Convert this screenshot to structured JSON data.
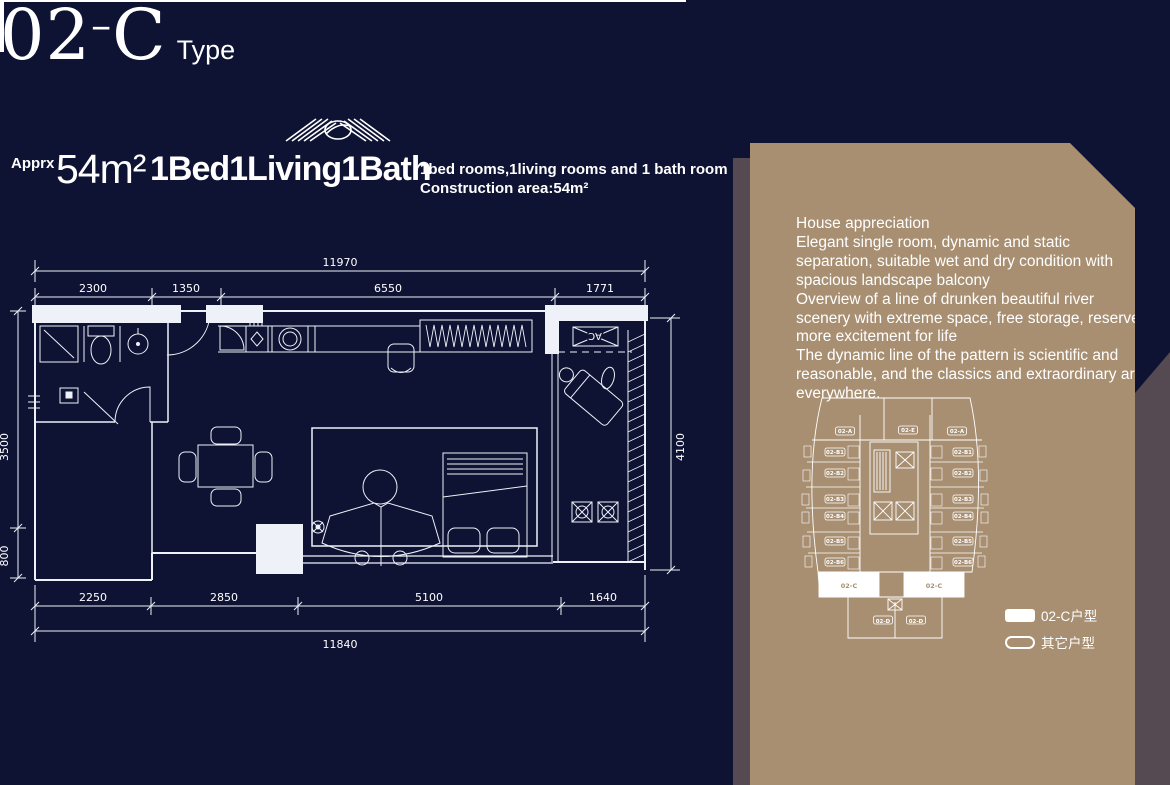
{
  "title": {
    "code_prefix": "02",
    "dash": "–",
    "code_suffix": "C",
    "type_label": "Type"
  },
  "summary": {
    "approx_label": "Apprx",
    "area": "54m²",
    "layout": "1Bed1Living1Bath",
    "desc_line1": "1bed rooms,1living rooms and 1 bath room",
    "desc_line2": "Construction area:54m²"
  },
  "plan": {
    "dim_top_total": "11970",
    "dims_top": [
      "2300",
      "1350",
      "6550",
      "1771"
    ],
    "dims_bottom": [
      "2250",
      "2850",
      "5100",
      "1640"
    ],
    "dim_bottom_total": "11840",
    "dim_right": "4100",
    "dim_left_upper": "3500",
    "dim_left_lower": "800",
    "ac_label": "AC"
  },
  "panel": {
    "description": [
      "House appreciation",
      "Elegant single room, dynamic and static separation, suitable wet and dry condition with spacious landscape balcony",
      "Overview of a line of drunken beautiful river scenery with extreme space, free storage, reserve more excitement for life",
      "The dynamic line of the pattern is scientific and reasonable, and the classics and extraordinary are everywhere."
    ],
    "floorplate": {
      "units": [
        "02-A",
        "02-E",
        "02-A",
        "02-B1",
        "02-B1",
        "02-B2",
        "02-B2",
        "02-B3",
        "02-B3",
        "02-B4",
        "02-B4",
        "02-B5",
        "02-B5",
        "02-B6",
        "02-B6",
        "02-C",
        "02-C",
        "02-D",
        "02-D"
      ]
    },
    "legend": [
      {
        "swatch": "filled",
        "label": "02-C户型"
      },
      {
        "swatch": "outline",
        "label": "其它户型"
      }
    ]
  },
  "colors": {
    "background_navy": "#0e1233",
    "panel_brown": "#a88f72",
    "shadow_purple": "#554a52",
    "line_white": "#ffffff"
  }
}
